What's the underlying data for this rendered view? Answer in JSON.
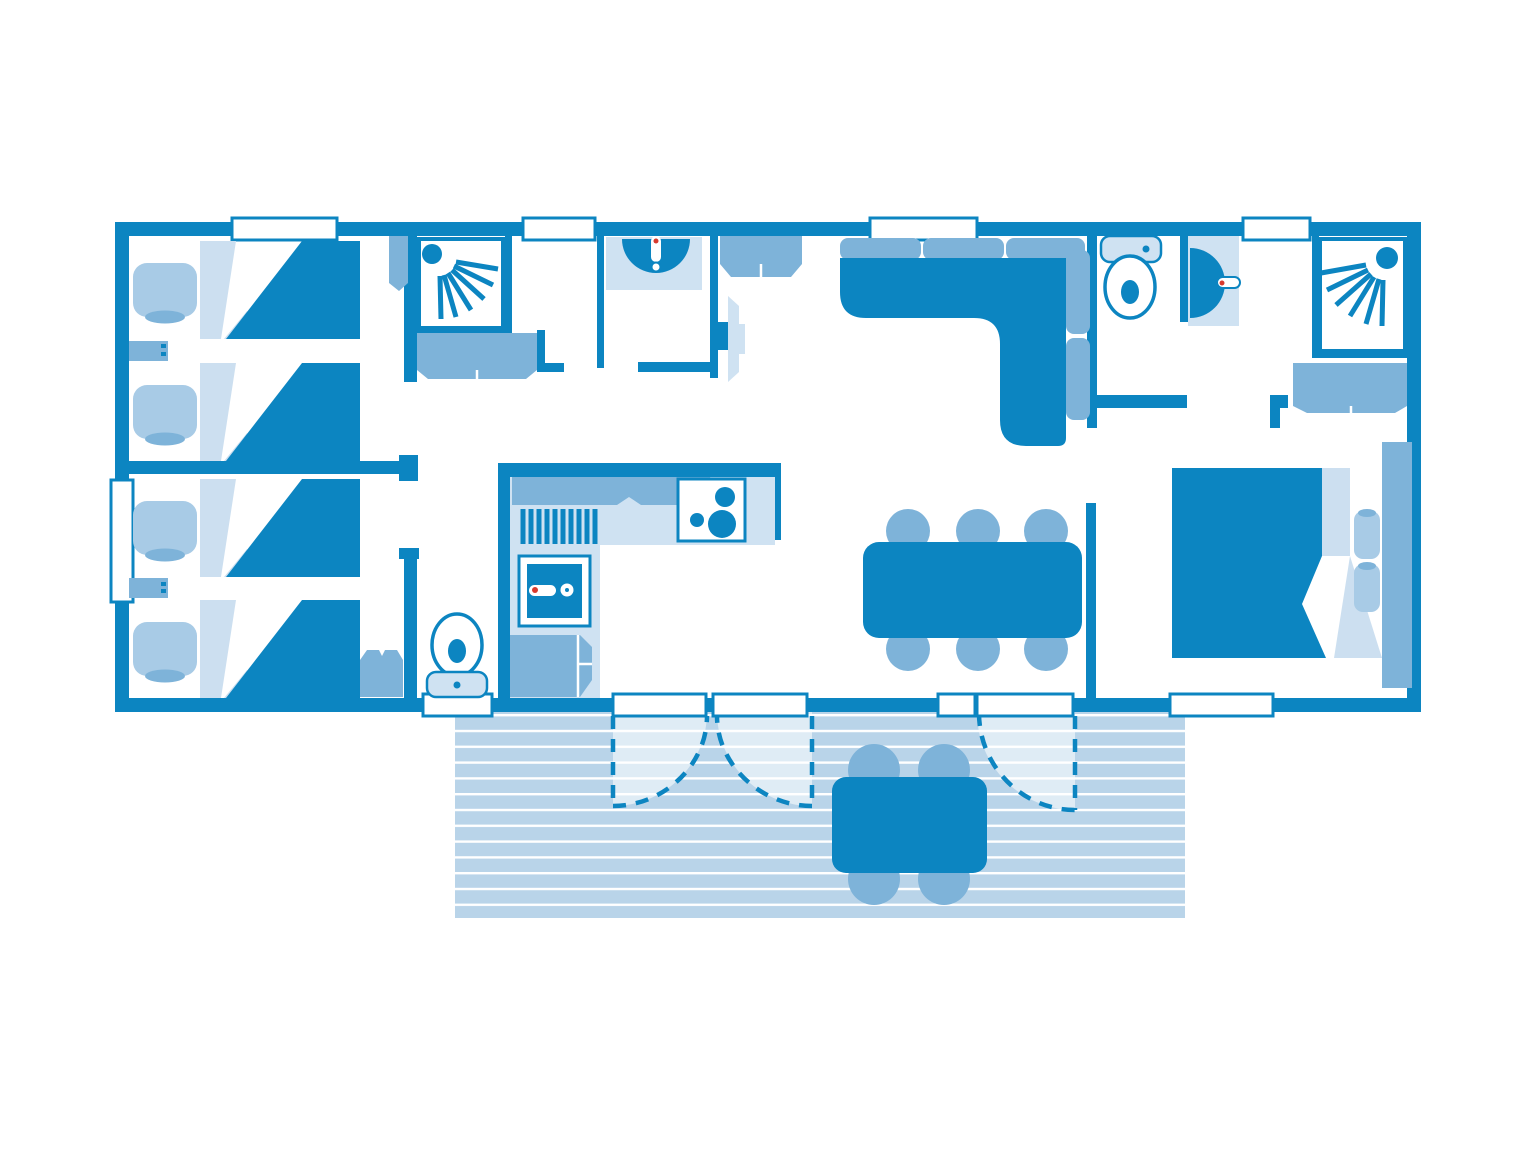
{
  "document": {
    "kind": "floor-plan",
    "style": "blueprint-monochrome-blue",
    "canvas": {
      "width": 1536,
      "height": 1152
    }
  },
  "palette": {
    "wall": "#0c85c1",
    "mid": "#7eb3d9",
    "soft": "#a8cbe6",
    "light": "#cfe2f2",
    "fold": "#ccdff0",
    "plank": "#b9d4e9",
    "red": "#d83a2e",
    "bg": "#ffffff"
  },
  "rooms": [
    {
      "id": "bedroom-twin-1",
      "label": "twin bedroom 1",
      "furniture": [
        "single-bed",
        "single-bed",
        "nightstand",
        "wardrobe"
      ]
    },
    {
      "id": "bedroom-twin-2",
      "label": "twin bedroom 2",
      "furniture": [
        "single-bed",
        "single-bed",
        "nightstand",
        "wardrobe"
      ]
    },
    {
      "id": "shower-room-1",
      "label": "shower room 1",
      "furniture": [
        "shower-cabin",
        "vanity-unit"
      ]
    },
    {
      "id": "washbasin-room",
      "label": "washbasin room",
      "furniture": [
        "washbasin"
      ]
    },
    {
      "id": "hall-wc",
      "label": "hallway wc",
      "furniture": [
        "toilet"
      ]
    },
    {
      "id": "kitchen",
      "label": "kitchen",
      "furniture": [
        "worktop",
        "wall-cabinet",
        "dish-rack",
        "hob",
        "kitchen-sink",
        "fridge"
      ]
    },
    {
      "id": "living-dining",
      "label": "living / dining room",
      "furniture": [
        "corner-sofa",
        "tv",
        "sideboard",
        "dining-table",
        "dining-chair x6"
      ]
    },
    {
      "id": "wc-2",
      "label": "wc 2",
      "furniture": [
        "toilet"
      ]
    },
    {
      "id": "shower-room-2",
      "label": "shower room 2",
      "furniture": [
        "washbasin",
        "shower-cabin",
        "closet"
      ]
    },
    {
      "id": "master-bedroom",
      "label": "master bedroom",
      "furniture": [
        "double-bed",
        "headboard",
        "pillow x2"
      ]
    },
    {
      "id": "terrace",
      "label": "decked terrace",
      "furniture": [
        "outdoor-table",
        "outdoor-chair x4"
      ]
    }
  ],
  "openings": {
    "windows": 7,
    "exterior_doors": [
      "french-double-door",
      "single-door"
    ],
    "door_swings_shown": 3
  }
}
